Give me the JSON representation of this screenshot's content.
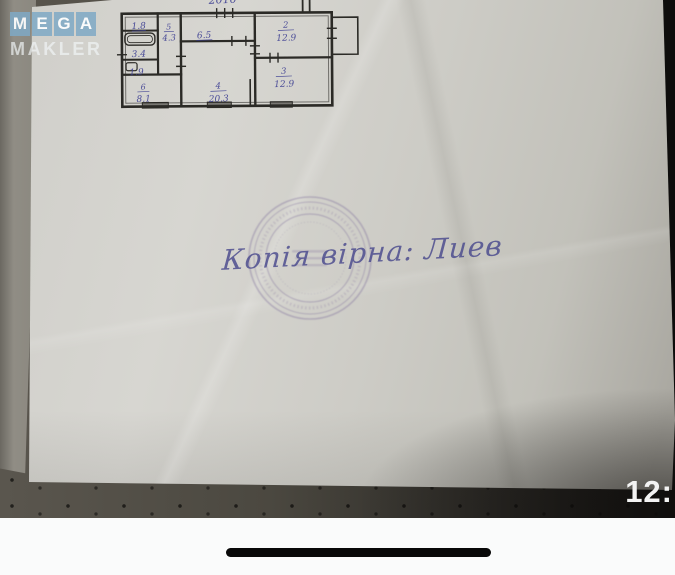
{
  "watermark": {
    "line1": "MEGA",
    "line2": "MAKLER",
    "tile_color": "#7fa9c5"
  },
  "floorplan": {
    "top_note": "2010",
    "ink_color": "#3c3e92",
    "rooms": [
      {
        "num": "",
        "area": "1.8"
      },
      {
        "num": "",
        "area": "3.4"
      },
      {
        "num": "",
        "area": "1.9"
      },
      {
        "num": "5",
        "area": "4.3"
      },
      {
        "num": "6",
        "area": "8.1"
      },
      {
        "num": "",
        "area": "6.5"
      },
      {
        "num": "4",
        "area": "20.3"
      },
      {
        "num": "2",
        "area": "12.9"
      },
      {
        "num": "3",
        "area": "12.9"
      }
    ]
  },
  "stamp": {
    "handwriting": "Копія вірна: Лиев",
    "color": "#8c7daa"
  },
  "ui": {
    "clock": "12:"
  },
  "colors": {
    "paper": "#d3d2cc",
    "fabric_dark": "#34322d",
    "accent_blue": "#7fa9c5"
  }
}
